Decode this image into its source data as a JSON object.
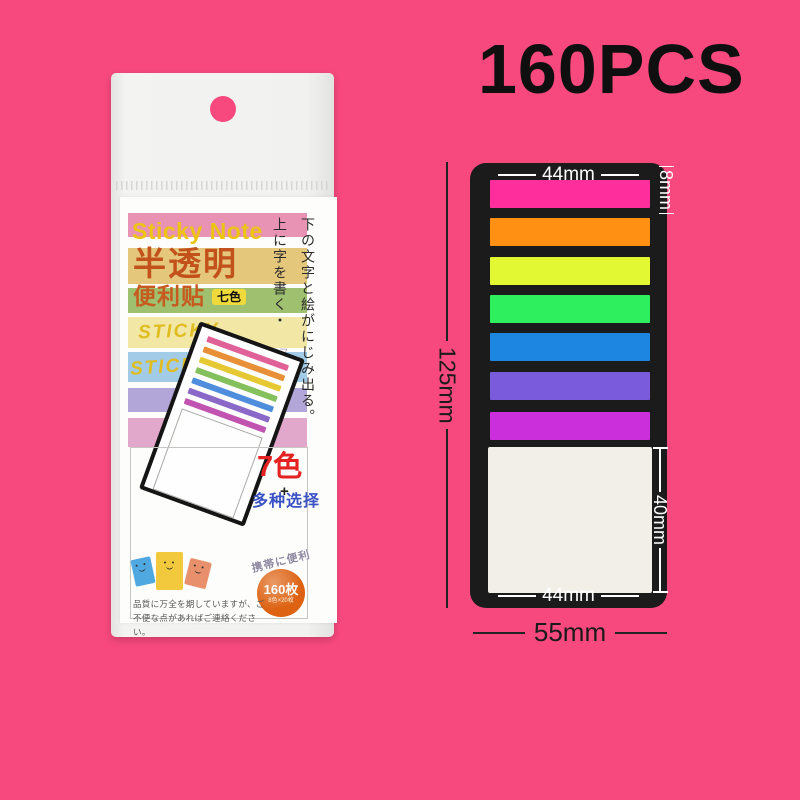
{
  "page": {
    "bg": "#f7497e",
    "count_label": "160PCS"
  },
  "package": {
    "brand_en": "Sticky Note",
    "title_cn": "半透明",
    "subtitle_cn": "便利贴",
    "badge_label": "七色",
    "badge_bg": "#f0d93a",
    "sticky_label_1": "STICKY",
    "sticky_label_2": "STICKY",
    "vertical_text_outer": "下の文字と絵がにじみ出る。",
    "vertical_text_inner": "上に字を書く・",
    "vertical_text_purple": "フィルム素材",
    "seven_colors_label": "7色",
    "plus_sign": "+",
    "choice_label": "多种选择",
    "carry_label": "携帯に便利",
    "count_circle_main": "160枚",
    "count_circle_sub": "8色×20枚",
    "count_circle_bg": "#dd6212",
    "quality_line1": "品質に万全を期していますが、ご",
    "quality_line2": "不便な点があればご連絡ください。",
    "stripe_colors": [
      "#e892b4",
      "#e5c77c",
      "#9fc06e",
      "#f2e7a5",
      "#a2cbe8",
      "#b2a5d7",
      "#e2a8cc"
    ],
    "pad_strip_colors": [
      "#e06098",
      "#e89038",
      "#e6c832",
      "#84c05c",
      "#4e8edc",
      "#8a68c8",
      "#c054b0"
    ],
    "smiley_note_colors": {
      "blue": "#4fa8e0",
      "yellow": "#f2c93c",
      "salmon": "#e8906c"
    }
  },
  "diagram": {
    "card_color": "#1b1b1b",
    "pad_color": "#f1efe8",
    "strip_colors": [
      "#ff2e9d",
      "#ff9014",
      "#e2f833",
      "#2eef5d",
      "#1c86e0",
      "#7a5bdb",
      "#cb2fdb"
    ],
    "dims": {
      "top_width": "44mm",
      "strip_height": "8mm",
      "total_height": "125mm",
      "pad_height": "40mm",
      "bottom_width": "44mm",
      "overall_width": "55mm"
    }
  }
}
